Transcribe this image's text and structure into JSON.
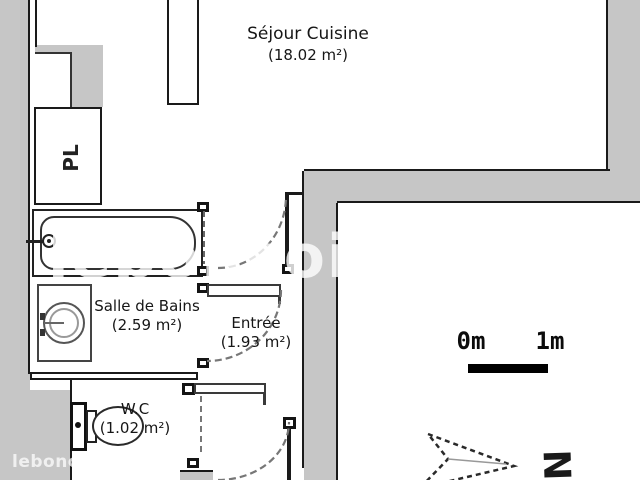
{
  "plan": {
    "rooms": [
      {
        "name": "Séjour Cuisine",
        "area": "(18.02 m²)"
      },
      {
        "name": "Salle de Bains",
        "area": "(2.59 m²)"
      },
      {
        "name": "Entrée",
        "area": "(1.93 m²)"
      },
      {
        "name": "W.C",
        "area": "(1.02 m²)"
      }
    ],
    "closet_label": "PL",
    "fixtures": [
      "bathtub",
      "bathtub-faucet",
      "washing-machine",
      "toilet",
      "door-swing-arc"
    ]
  },
  "scale_bar": {
    "start_label": "0m",
    "end_label": "1m"
  },
  "compass": {
    "north_label": "N"
  },
  "watermark": {
    "center_text": "leboncoin",
    "corner_text": "leboncoin"
  },
  "colors": {
    "background": "#ffffff",
    "wall_fill": "#c6c6c6",
    "line": "#1a1a1a",
    "scale_bar": "#000000",
    "door_arc": "#777777"
  }
}
